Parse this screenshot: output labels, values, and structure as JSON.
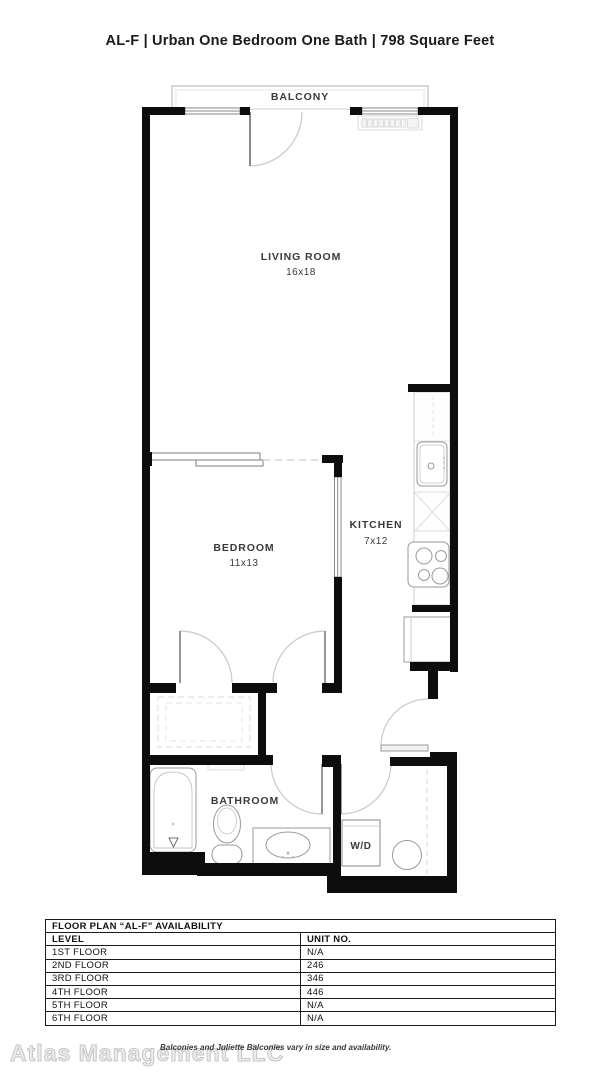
{
  "title": "AL-F | Urban One Bedroom One Bath | 798 Square Feet",
  "floor_plan": {
    "rooms": {
      "balcony": {
        "label": "BALCONY"
      },
      "living_room": {
        "label": "LIVING ROOM",
        "dimensions": "16x18"
      },
      "bedroom": {
        "label": "BEDROOM",
        "dimensions": "11x13"
      },
      "kitchen": {
        "label": "KITCHEN",
        "dimensions": "7x12"
      },
      "bathroom": {
        "label": "BATHROOM"
      },
      "laundry": {
        "label": "W/D"
      }
    }
  },
  "availability_table": {
    "title": "FLOOR PLAN “AL-F” AVAILABILITY",
    "columns": [
      "LEVEL",
      "UNIT NO."
    ],
    "rows": [
      {
        "level": "1ST FLOOR",
        "unit": "N/A"
      },
      {
        "level": "2ND FLOOR",
        "unit": "246"
      },
      {
        "level": "3RD FLOOR",
        "unit": "346"
      },
      {
        "level": "4TH FLOOR",
        "unit": "446"
      },
      {
        "level": "5TH FLOOR",
        "unit": "N/A"
      },
      {
        "level": "6TH FLOOR",
        "unit": "N/A"
      }
    ]
  },
  "footer": {
    "watermark": "Atlas Management LLC",
    "disclaimer": "Balconies and Juliette Balconies vary in size and availability."
  },
  "colors": {
    "wall": "#0d0d0d",
    "fixture_line": "#9a9a9a",
    "light_line": "#d6d6d6"
  }
}
